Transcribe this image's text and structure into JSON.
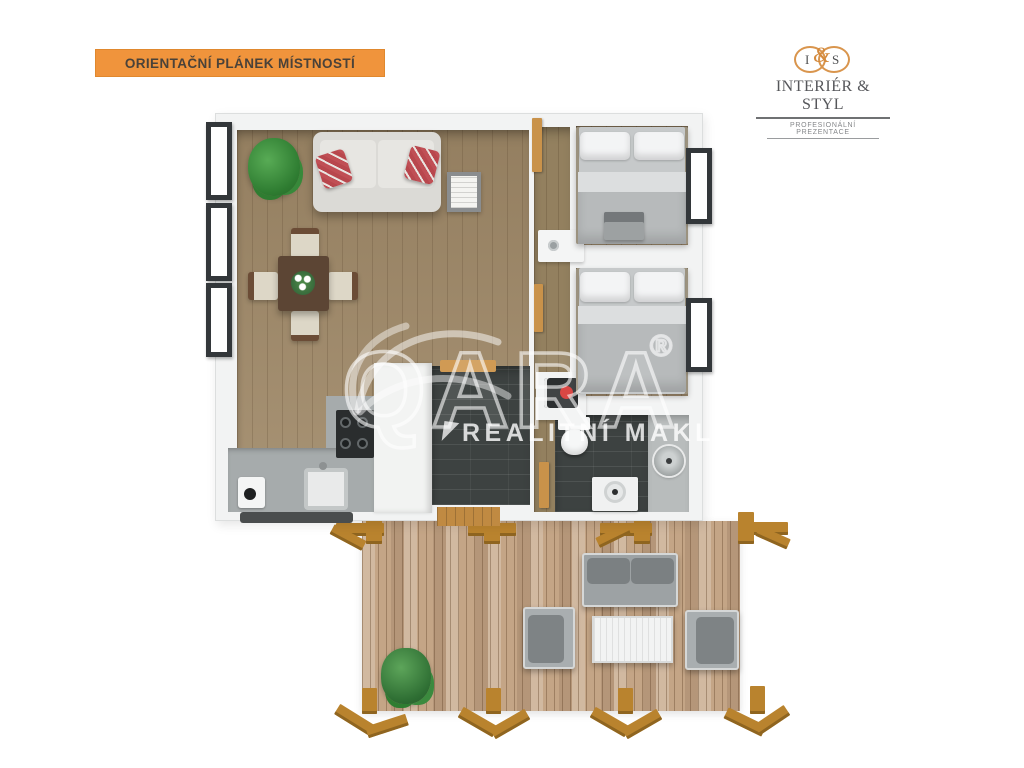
{
  "badge": {
    "label": "ORIENTAČNÍ PLÁNEK MÍSTNOSTÍ"
  },
  "logo": {
    "initial_left": "I",
    "ampersand": "&",
    "initial_right": "S",
    "name": "INTERIÉR & STYL",
    "tagline": "PROFESIONÁLNÍ PREZENTACE"
  },
  "watermark": {
    "brand": "QARA",
    "registered": "®",
    "tagline": "REALITNÍ MAKLÉŘI"
  },
  "colors": {
    "badge_orange": "#F0943C",
    "logo_ring_orange": "#D9954D",
    "floor_wood": "#A08A6A",
    "hall_wood": "#93805F",
    "deck_wood": "#C4A586",
    "dark_tile": "#3D4241",
    "kitchen_counter": "#A6ABAC",
    "pillow_red": "#C04F55",
    "pergola_wood": "#B9832E",
    "window_frame": "#33373A"
  }
}
